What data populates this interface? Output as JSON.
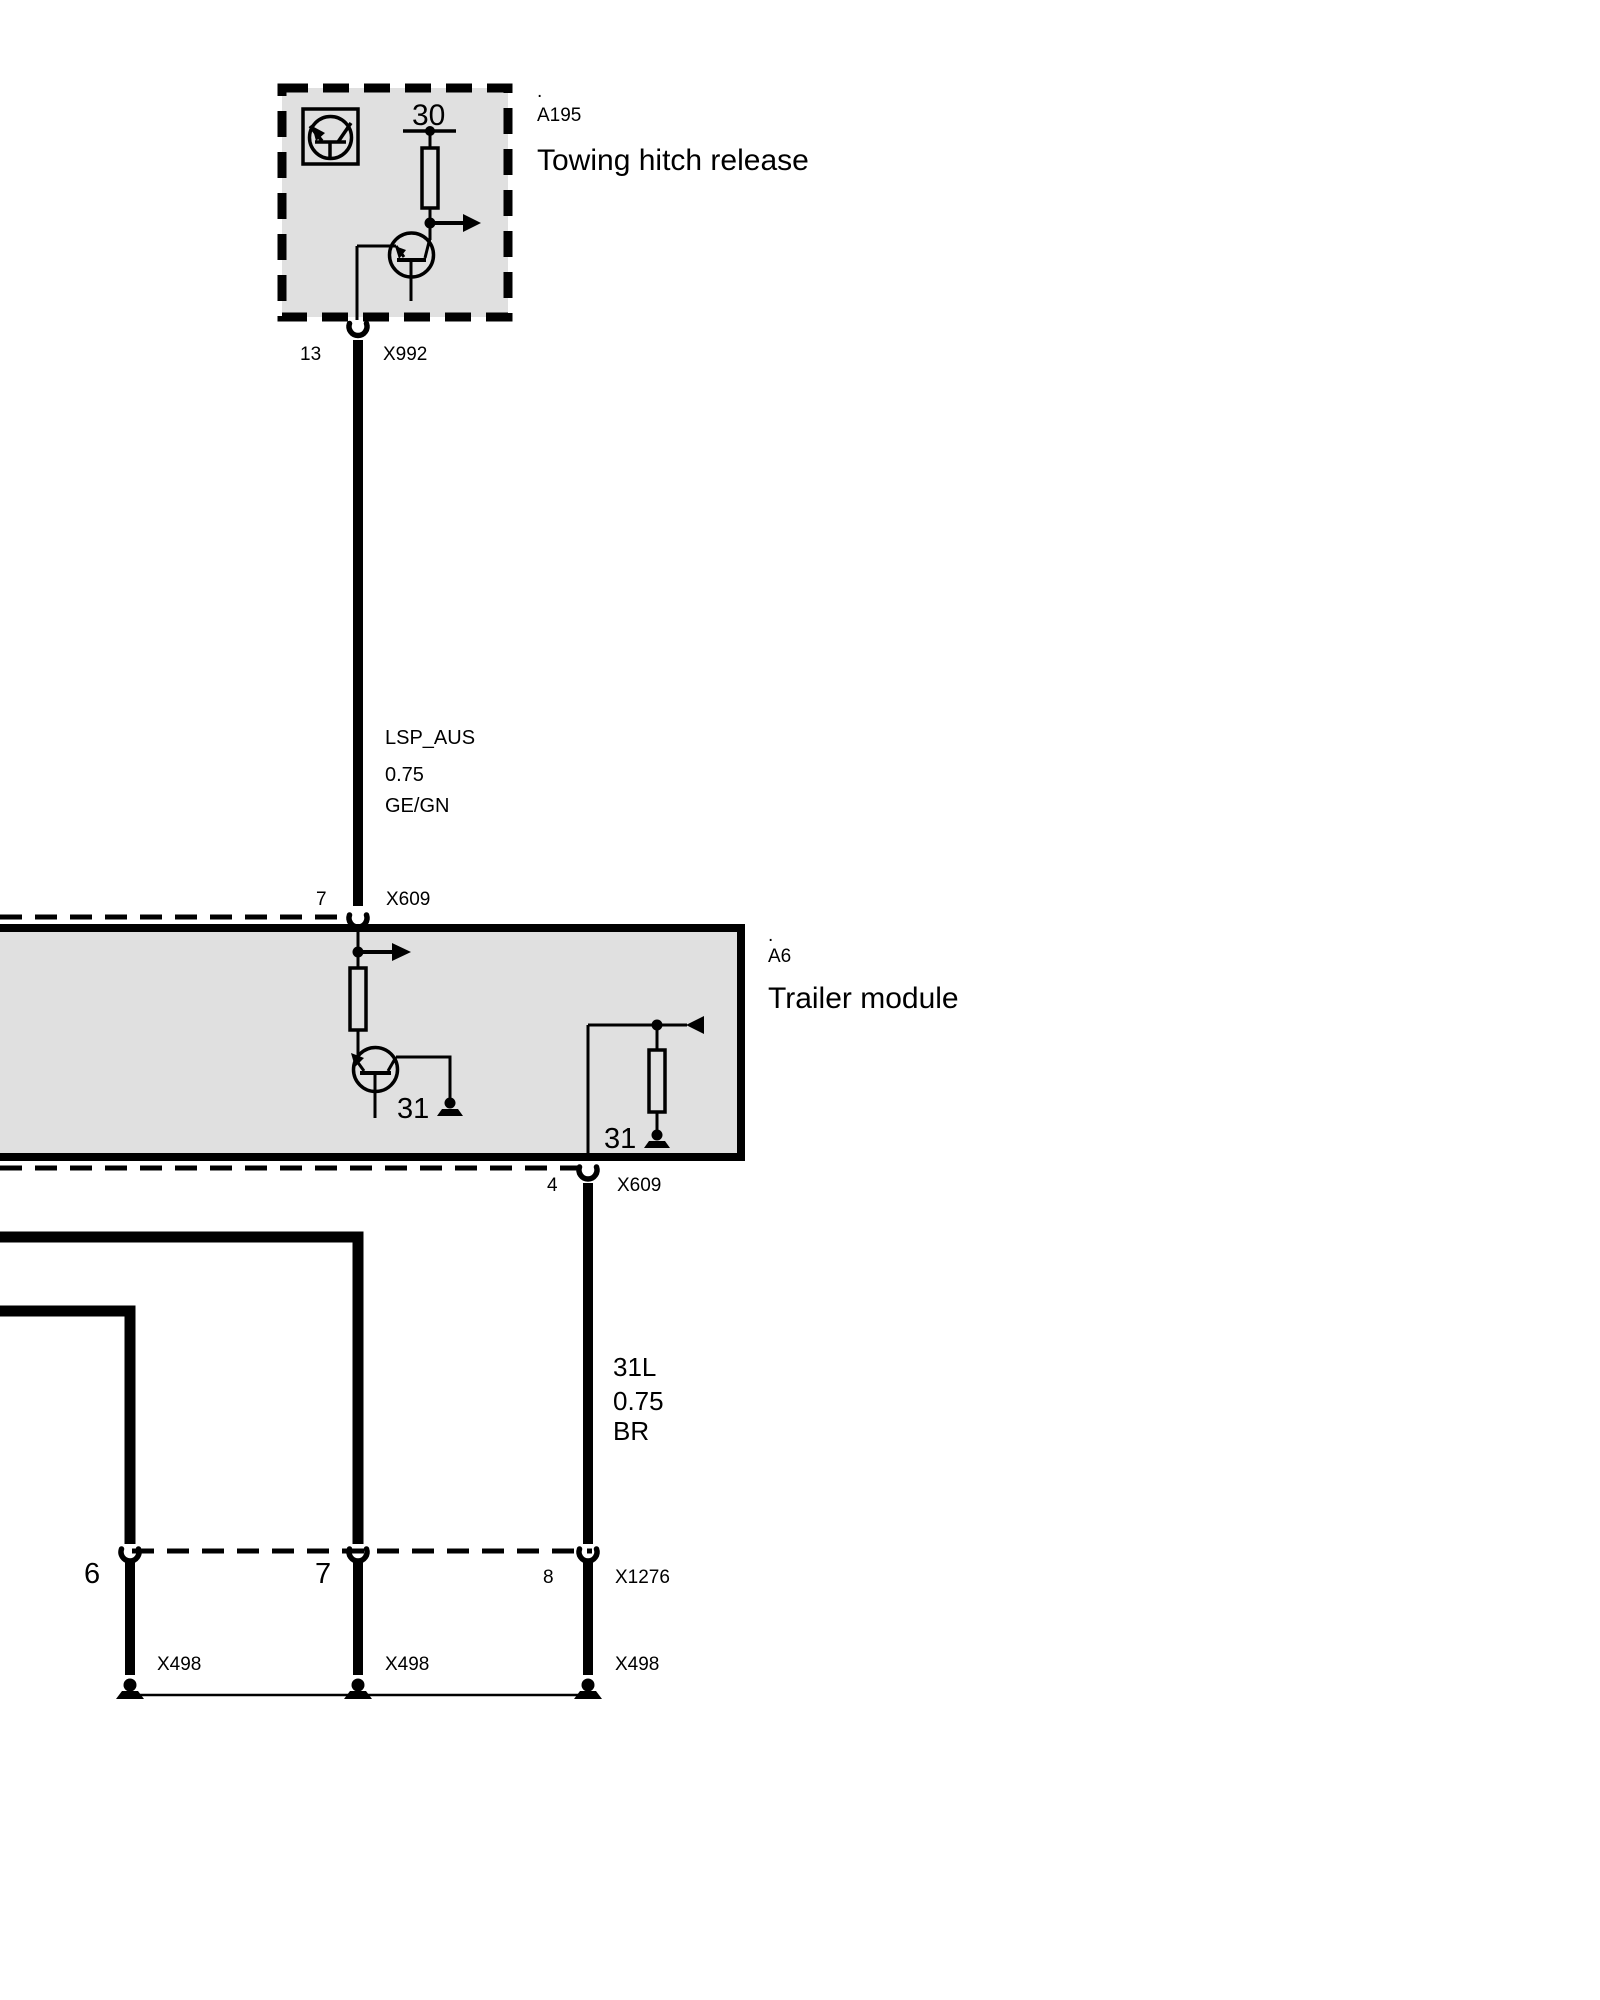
{
  "colors": {
    "background": "#ffffff",
    "line": "#000000",
    "module_fill": "#e0e0e0"
  },
  "modules": {
    "towing_hitch_release": {
      "dot": ".",
      "id": "A195",
      "name": "Towing hitch release",
      "terminal": "30"
    },
    "trailer_module": {
      "dot": ".",
      "id": "A6",
      "name": "Trailer module",
      "terminal_left": "31",
      "terminal_right": "31"
    }
  },
  "connectors": {
    "x992": {
      "pin": "13",
      "id": "X992"
    },
    "x609_top": {
      "pin": "7",
      "id": "X609"
    },
    "x609_bottom": {
      "pin": "4",
      "id": "X609"
    },
    "x1276": {
      "pin_left": "6",
      "pin_middle": "7",
      "pin_right": "8",
      "id": "X1276"
    },
    "x498": {
      "left": "X498",
      "middle": "X498",
      "right": "X498"
    }
  },
  "wires": {
    "lsp_aus": {
      "name": "LSP_AUS",
      "cross_section": "0.75",
      "color_code": "GE/GN"
    },
    "ground_31l": {
      "name": "31L",
      "cross_section": "0.75",
      "color_code": "BR"
    }
  }
}
